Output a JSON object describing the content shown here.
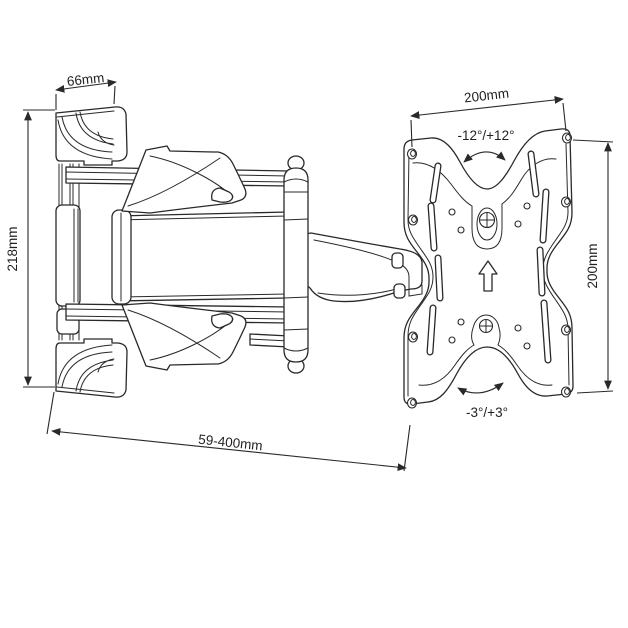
{
  "colors": {
    "background": "#ffffff",
    "line": "#2b282b",
    "text": "#231f20"
  },
  "labels": {
    "arm_depth": "66mm",
    "wall_bracket_height": "218mm",
    "plate_width": "200mm",
    "plate_height": "200mm",
    "extension_range": "59-400mm",
    "swivel_range": "-12°/+12°",
    "tilt_range": "-3°/+3°"
  }
}
